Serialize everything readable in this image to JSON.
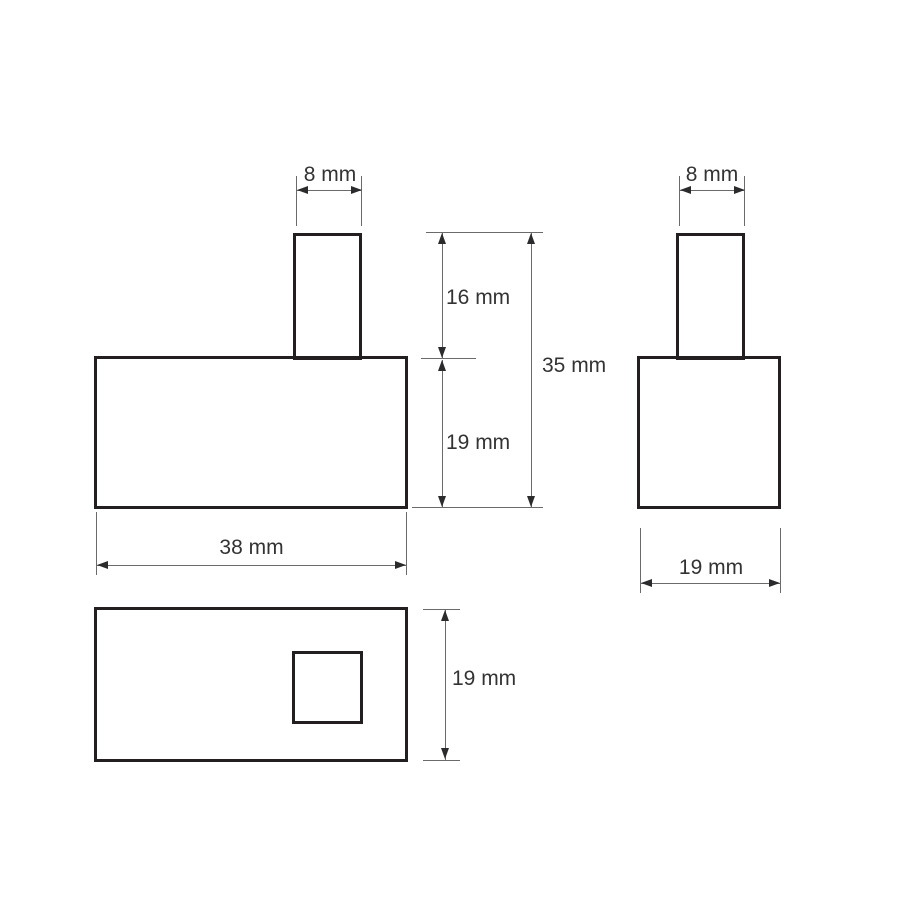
{
  "drawing": {
    "type": "technical-dimension-drawing",
    "unit": "mm",
    "background": "#ffffff",
    "outline_color": "#231f20",
    "dimension_line_color": "#6a6a6d",
    "text_color": "#333333",
    "views": {
      "front": {
        "name": "front view",
        "labels": {
          "tab_width": "8 mm",
          "tab_height": "16 mm",
          "total_height": "35 mm",
          "body_height": "19 mm",
          "body_width": "38 mm"
        },
        "values": {
          "tab_width_mm": 8,
          "tab_height_mm": 16,
          "total_height_mm": 35,
          "body_height_mm": 19,
          "body_width_mm": 38
        }
      },
      "side": {
        "name": "side view",
        "labels": {
          "tab_width": "8 mm",
          "body_width": "19 mm"
        },
        "values": {
          "tab_width_mm": 8,
          "body_width_mm": 19
        }
      },
      "top": {
        "name": "top view",
        "labels": {
          "body_depth": "19 mm"
        },
        "values": {
          "body_depth_mm": 19
        }
      }
    }
  }
}
